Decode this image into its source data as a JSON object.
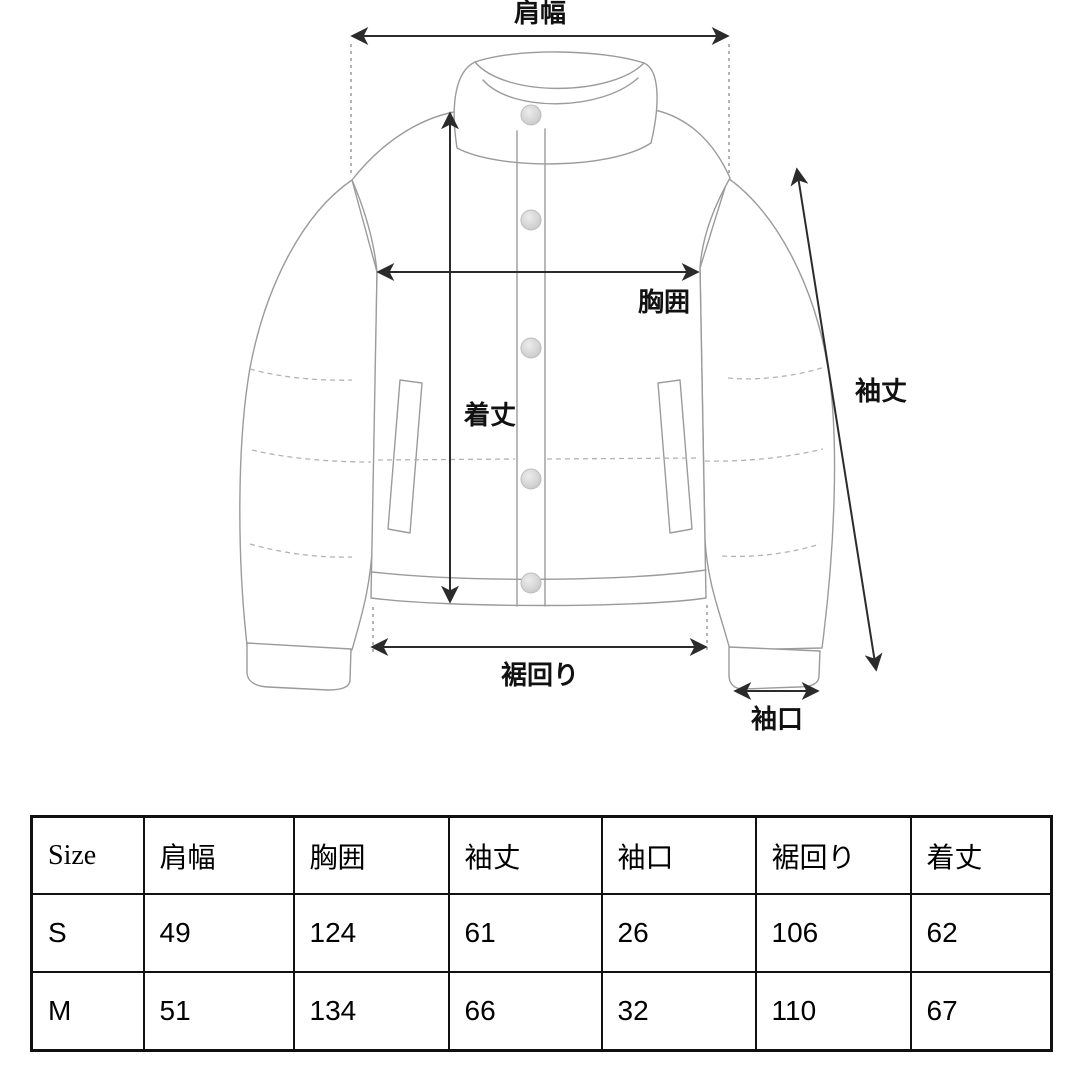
{
  "diagram": {
    "labels": {
      "shoulder": "肩幅",
      "chest": "胸囲",
      "body_length": "着丈",
      "sleeve_length": "袖丈",
      "hem": "裾回り",
      "cuff": "袖口"
    }
  },
  "table": {
    "headers": [
      "Size",
      "肩幅",
      "胸囲",
      "袖丈",
      "袖口",
      "裾回り",
      "着丈"
    ],
    "rows": [
      {
        "size": "S",
        "values": [
          "49",
          "124",
          "61",
          "26",
          "106",
          "62"
        ]
      },
      {
        "size": "M",
        "values": [
          "51",
          "134",
          "66",
          "32",
          "110",
          "67"
        ]
      }
    ]
  },
  "colors": {
    "outline": "#9b9b9b",
    "quilt_dash": "#b3b3b3",
    "dimension": "#2b2b2b",
    "table_border": "#111111",
    "background": "#ffffff"
  }
}
